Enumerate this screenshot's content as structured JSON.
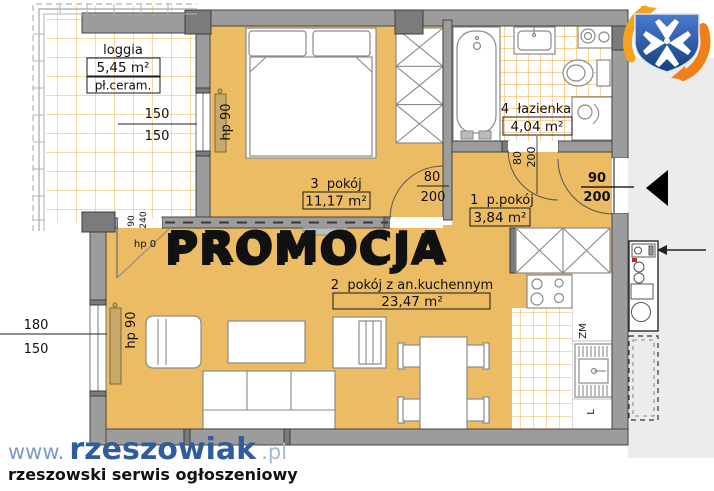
{
  "promo": {
    "text": "PROMOCJA"
  },
  "rooms": {
    "loggia": {
      "name": "loggia",
      "area": "5,45 m²",
      "floor_label": "pł.ceram."
    },
    "room3": {
      "name": "3  pokój",
      "area": "11,17 m²"
    },
    "bath": {
      "name": "4  łazienka",
      "area": "4,04 m²"
    },
    "hall": {
      "name": "1  p.pokój",
      "area": "3,84 m²"
    },
    "room2": {
      "name": "2  pokój z an.kuchennym",
      "area": "23,47 m²"
    }
  },
  "dims": {
    "loggia_top": "150",
    "loggia_bottom": "150",
    "living_top": "180",
    "living_bottom": "150",
    "bedroom_door": {
      "w": "80",
      "h": "200"
    },
    "bath_door": {
      "w": "80",
      "h": "200"
    },
    "entry": {
      "w": "90",
      "h": "200"
    },
    "balcony_door": {
      "w": "90",
      "h": "240"
    }
  },
  "labels": {
    "hp90_bedroom": "hp 90",
    "hp90_living": "hp 90",
    "hp0": "hp 0"
  },
  "kitchen": {
    "sink": "ZM",
    "fridge": "L"
  },
  "watermark": {
    "prefix": "www.",
    "domain": "rzeszowiak",
    "tld": ".pl",
    "tagline": "rzeszowski serwis ogłoszeniowy"
  },
  "colors": {
    "floor": "#ebbc63",
    "tile_line": "#f1b54b",
    "wall": "#9c9c9c",
    "corridor": "#ececec",
    "promo_pink": "#e9417f",
    "promo_shadow": "#9e1c38",
    "wm_blue_light": "#7c9cc8",
    "wm_blue": "#2f5c9e",
    "wm_blue_tld": "#a3b8d6",
    "wm_orange": "#e8891c",
    "logo_blue": "#1f4c94",
    "logo_orange": "#ef7f1a",
    "logo_yellow": "#f6a21d"
  }
}
